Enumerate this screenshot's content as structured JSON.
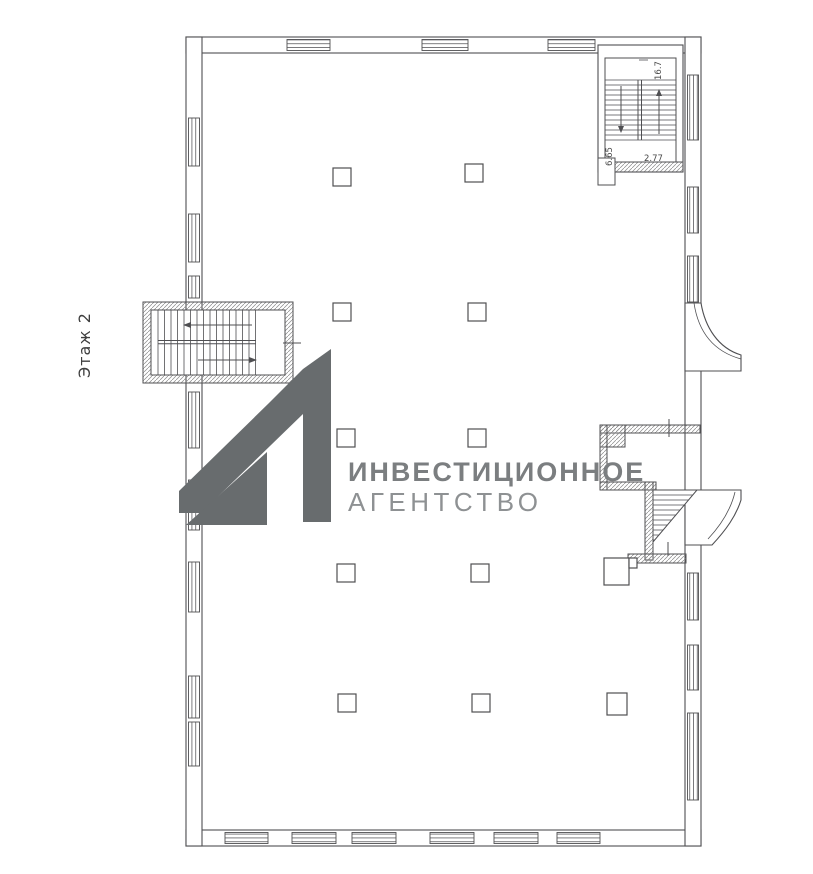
{
  "colors": {
    "background": "#ffffff",
    "plan_line": "#4f4f52",
    "glazing_line": "#5a5a5e",
    "hatch_line": "#8a8a8a",
    "logo": "#686c6e",
    "logo_text_primary": "#7b7e80",
    "logo_text_secondary": "#8e9193",
    "label_text": "#3f3f3f",
    "dim_text": "#4a4a4a"
  },
  "floor_label": "Этаж 2",
  "watermark": {
    "line1": "ИНВЕСТИЦИОННОЕ",
    "line2": "АГЕНТСТВО"
  },
  "dimensions": {
    "stair_width": "2.77",
    "stair_depth": "6.65",
    "stair_mark": "16.7"
  }
}
